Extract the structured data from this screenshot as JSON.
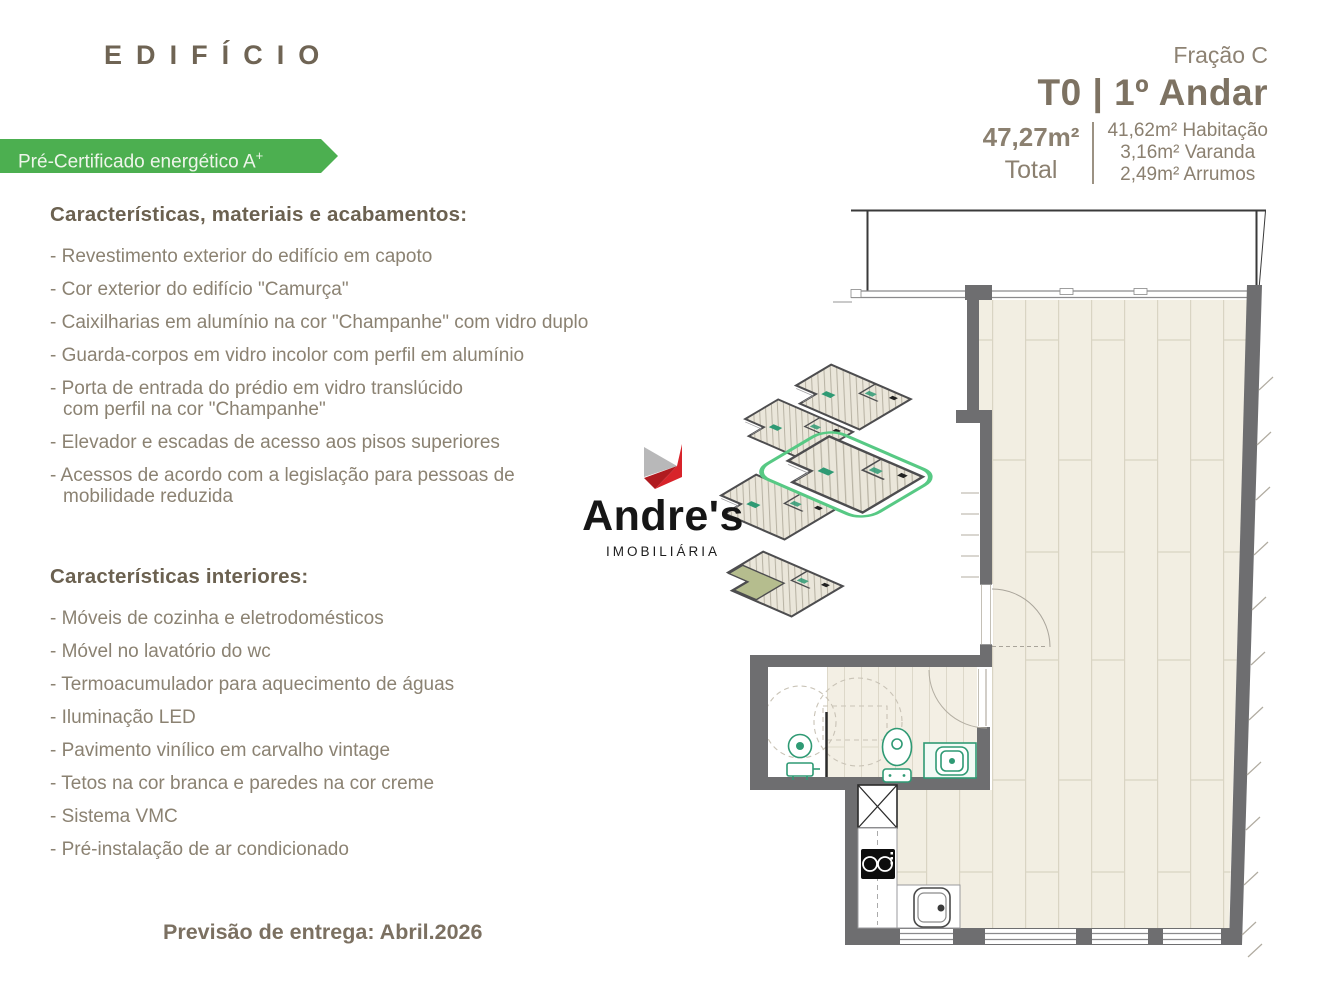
{
  "brand": {
    "title": "EDIFÍCIO"
  },
  "badge": {
    "text": "Pré-Certificado energético A",
    "superscript": "+",
    "color": "#4caf50"
  },
  "unit_header": {
    "fraction": "Fração C",
    "title": "T0 | 1º Andar",
    "total": {
      "value": "47,27m²",
      "label": "Total"
    },
    "areas": [
      "41,62m² Habitação",
      "3,16m² Varanda",
      "2,49m² Arrumos"
    ]
  },
  "sections": [
    {
      "heading": "Características, materiais e acabamentos:",
      "items": [
        "- Revestimento exterior do edifício em capoto",
        "- Cor exterior do edifício \"Camurça\"",
        "- Caixilharias em alumínio na cor \"Champanhe\" com vidro duplo",
        "- Guarda-corpos em vidro incolor com perfil em alumínio",
        "- Porta de entrada do prédio em vidro translúcido\ncom perfil na cor \"Champanhe\"",
        "- Elevador e escadas de acesso aos pisos superiores",
        "- Acessos de acordo com a legislação para pessoas de\nmobilidade reduzida"
      ]
    },
    {
      "heading": "Características interiores:",
      "items": [
        "- Móveis de cozinha e eletrodomésticos",
        "- Móvel no lavatório do wc",
        "- Termoacumulador para aquecimento de águas",
        "- Iluminação LED",
        "- Pavimento vinílico em carvalho vintage",
        "- Tetos na cor branca e paredes na cor creme",
        "- Sistema VMC",
        "- Pré-instalação de ar condicionado"
      ]
    }
  ],
  "delivery": {
    "text": "Previsão de entrega: Abril.2026"
  },
  "logo": {
    "name": "Andre's",
    "subtitle": "IMOBILIÁRIA",
    "red": "#d8232a",
    "dark_red": "#b01b20",
    "gray": "#b8b8b9"
  },
  "plan_colors": {
    "wall_gray": "#6e6e70",
    "floor_cream": "#f2eee2",
    "plank_seam": "#d9d4c3",
    "fixture_green": "#2f9a74",
    "highlight_green": "#57c984",
    "terrace_green": "#b5bd8e"
  }
}
